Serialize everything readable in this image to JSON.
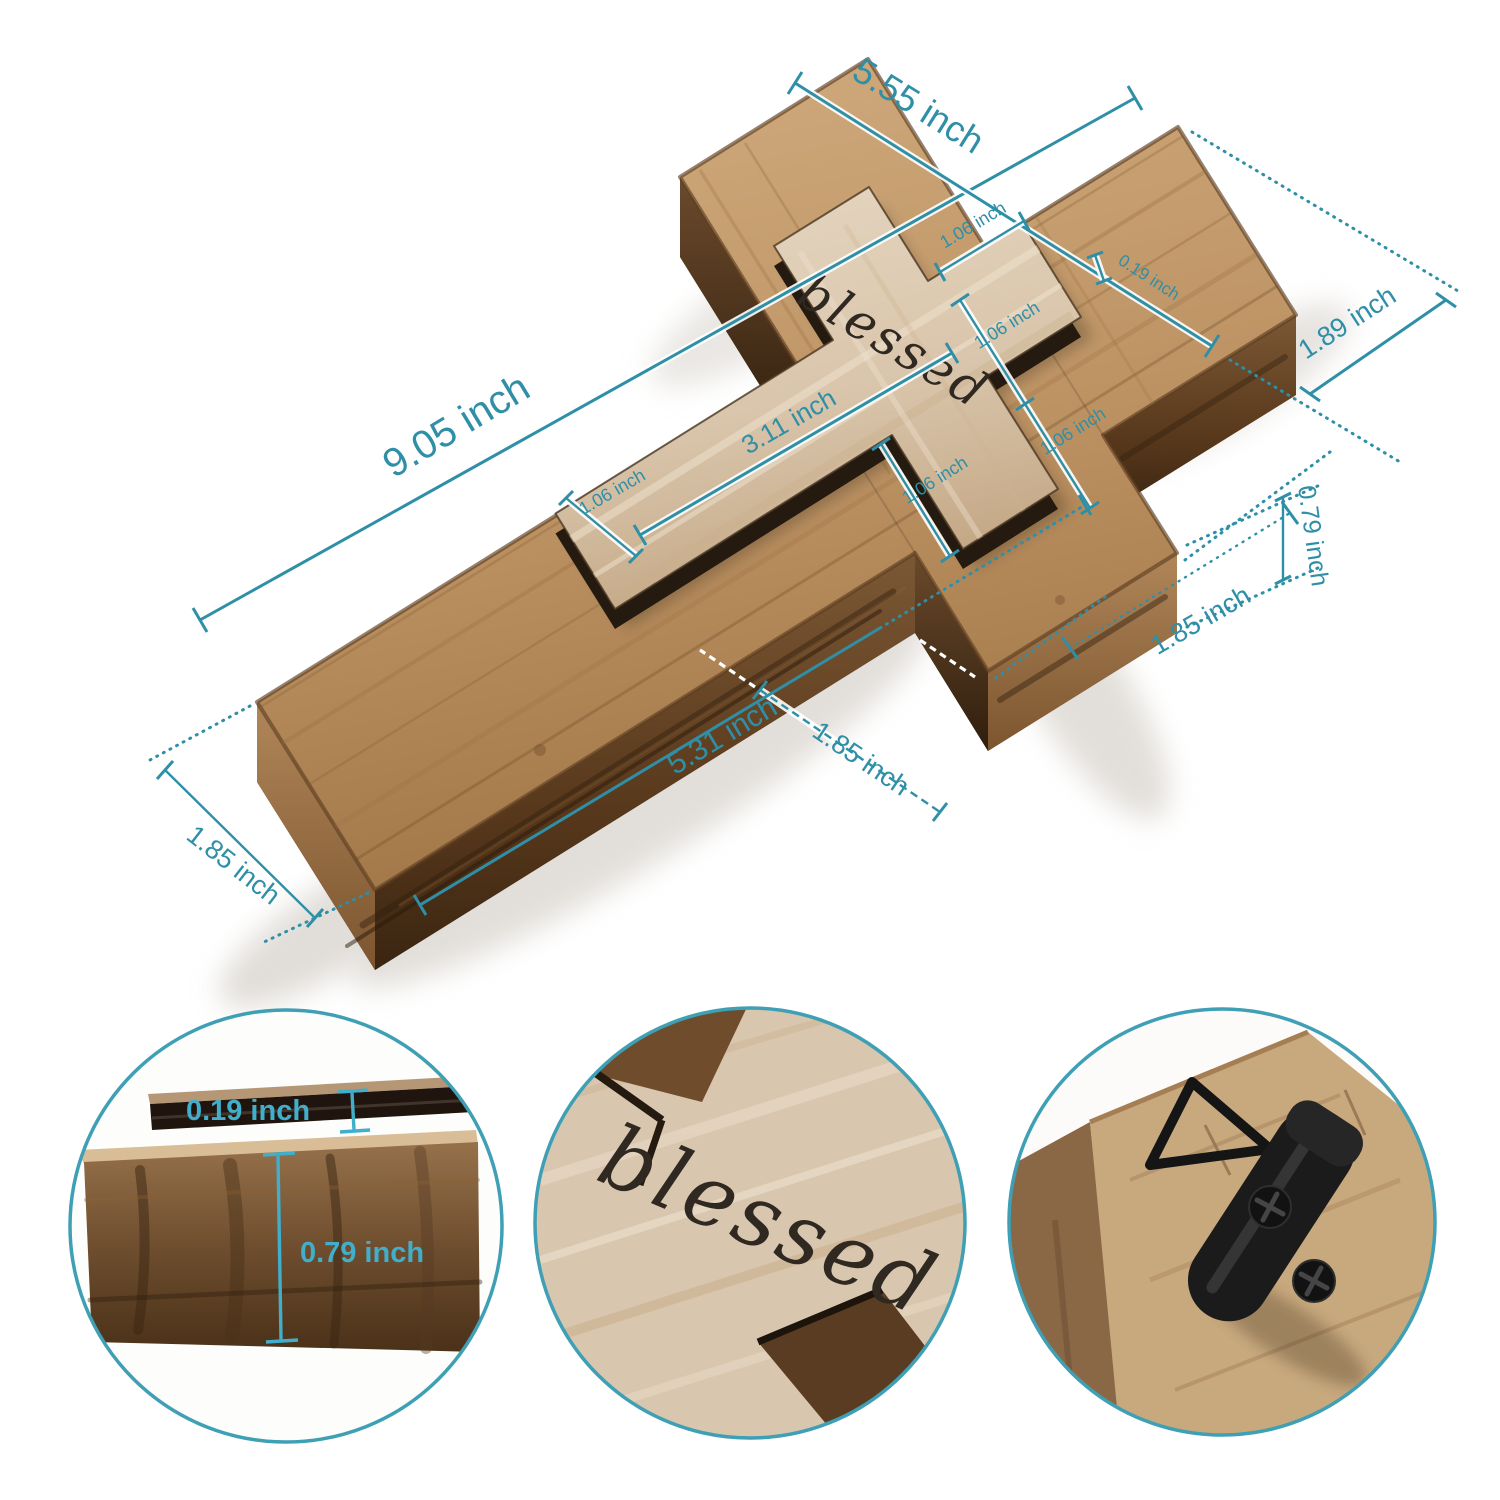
{
  "product": {
    "name": "rustic-wood-wall-cross",
    "engraving": "blessed"
  },
  "colors": {
    "dimension_teal": "#2E8FA7",
    "circle_ring_teal": "#3E9FB5",
    "detail_label_cyan": "#41AECB",
    "wood_top": "#C3996B",
    "wood_side_dark": "#4A3118",
    "plaque_whitewash": "#DDCBB2",
    "hanger_black": "#191919",
    "background": "#FFFFFF"
  },
  "dimensions": {
    "arm_span": "5.55 inch",
    "overall_length": "9.05 inch",
    "head_length": "1.89 inch",
    "plaque_thickness": "0.19 inch",
    "plaque_head_width": "1.06 inch",
    "plaque_stem_length": "3.11 inch",
    "plaque_foot_width": "1.06 inch",
    "plaque_cross_width": "1.06 inch",
    "plaque_arm_length": "1.06 inch",
    "plaque_arm_width": "1.06 inch",
    "board_thickness": "0.79 inch",
    "arm_end_width": "1.85 inch",
    "notch_width": "1.85 inch",
    "stem_length": "5.31 inch",
    "foot_width": "1.85 inch"
  },
  "detail_circles": {
    "thickness_detail": {
      "plaque_thickness": "0.19 inch",
      "board_thickness": "0.79 inch"
    },
    "engraving_detail": {
      "engraving": "blessed"
    },
    "hanger_detail": {
      "hardware": "d-ring-hanger"
    }
  }
}
